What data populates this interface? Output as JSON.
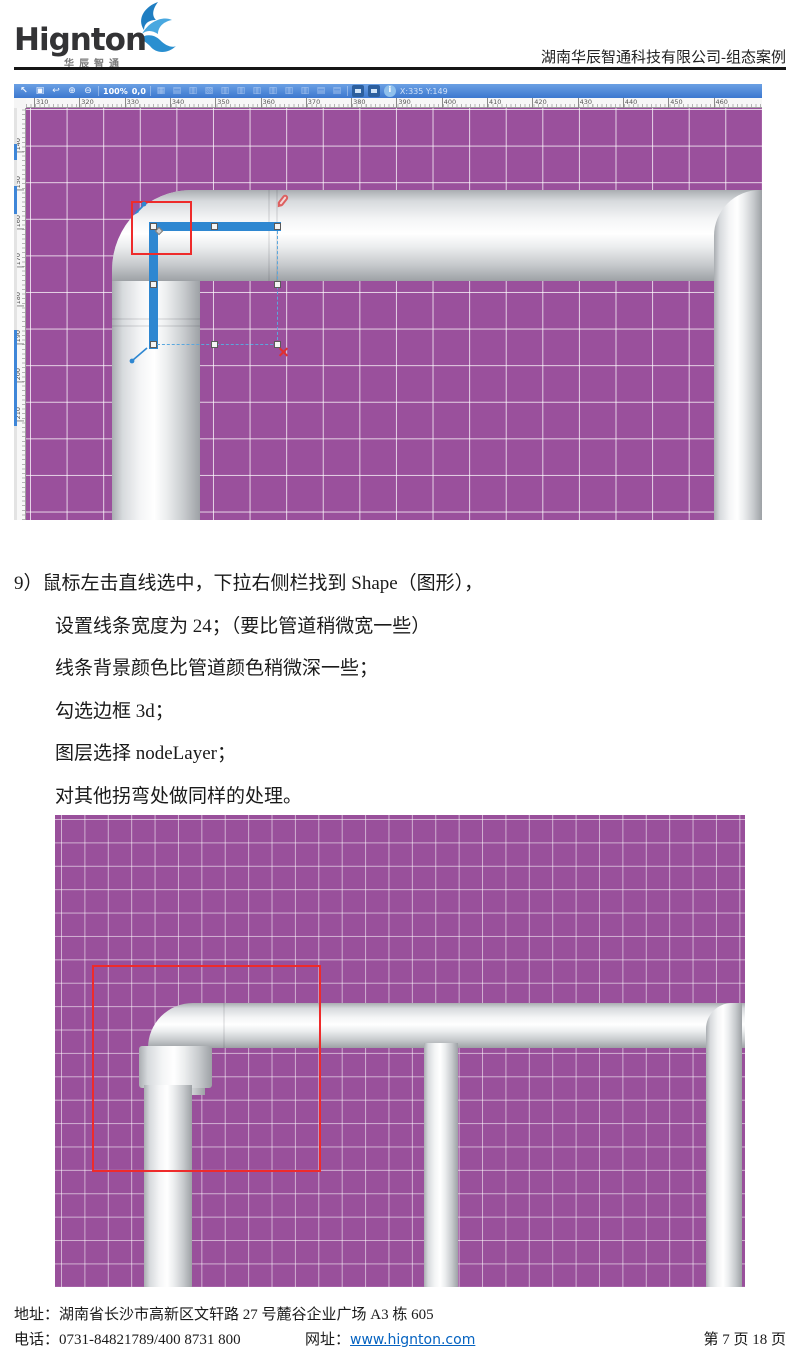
{
  "header": {
    "logo_text": "Hignton",
    "logo_subtext": "华辰智通",
    "doc_title": "湖南华辰智通科技有限公司-组态案例"
  },
  "screenshot1": {
    "toolbar": {
      "icons_left": [
        "cursor",
        "save",
        "undo",
        "zoom-in",
        "zoom-out"
      ],
      "zoom_level": "100%",
      "origin": "0,0",
      "icons_mid": [
        "grid",
        "copy",
        "paste",
        "cut",
        "align-left",
        "align-center",
        "align-right",
        "align-top",
        "align-middle",
        "align-bottom",
        "same-width",
        "same-height"
      ],
      "icons_right": [
        "folder-open",
        "folder-new",
        "info"
      ],
      "coords": "X:335 Y:149"
    },
    "h_ruler": [
      "310",
      "320",
      "330",
      "340",
      "350",
      "360",
      "370",
      "380",
      "390",
      "400",
      "410",
      "420",
      "430",
      "440",
      "450",
      "460"
    ],
    "v_ruler": [
      "140",
      "150",
      "160",
      "170",
      "180",
      "190",
      "200",
      "210"
    ]
  },
  "instructions": {
    "lines": [
      {
        "text": "9）鼠标左击直线选中，下拉右侧栏找到 Shape（图形），",
        "indent": false
      },
      {
        "text": "设置线条宽度为 24；（要比管道稍微宽一些）",
        "indent": true
      },
      {
        "text": "线条背景颜色比管道颜色稍微深一些；",
        "indent": true
      },
      {
        "text": "勾选边框 3d；",
        "indent": true
      },
      {
        "text": "图层选择 nodeLayer；",
        "indent": true
      },
      {
        "text": "对其他拐弯处做同样的处理。",
        "indent": true
      }
    ]
  },
  "footer": {
    "address": "地址：湖南省长沙市高新区文轩路 27 号麓谷企业广场 A3 栋 605",
    "phone": "电话：0731-84821789/400 8731 800",
    "web_label": "网址：",
    "web_url": "www.hignton.com",
    "page_info": "第 7 页 18 页"
  },
  "colors": {
    "canvas_purple": "#9a509c",
    "toolbar_blue": "#3c78cf",
    "selection_blue": "#2e87d1",
    "highlight_red": "#ee2b2b",
    "link_blue": "#0563c1",
    "pipe_highlight": "#ffffff",
    "pipe_shadow": "#9da1a5"
  }
}
